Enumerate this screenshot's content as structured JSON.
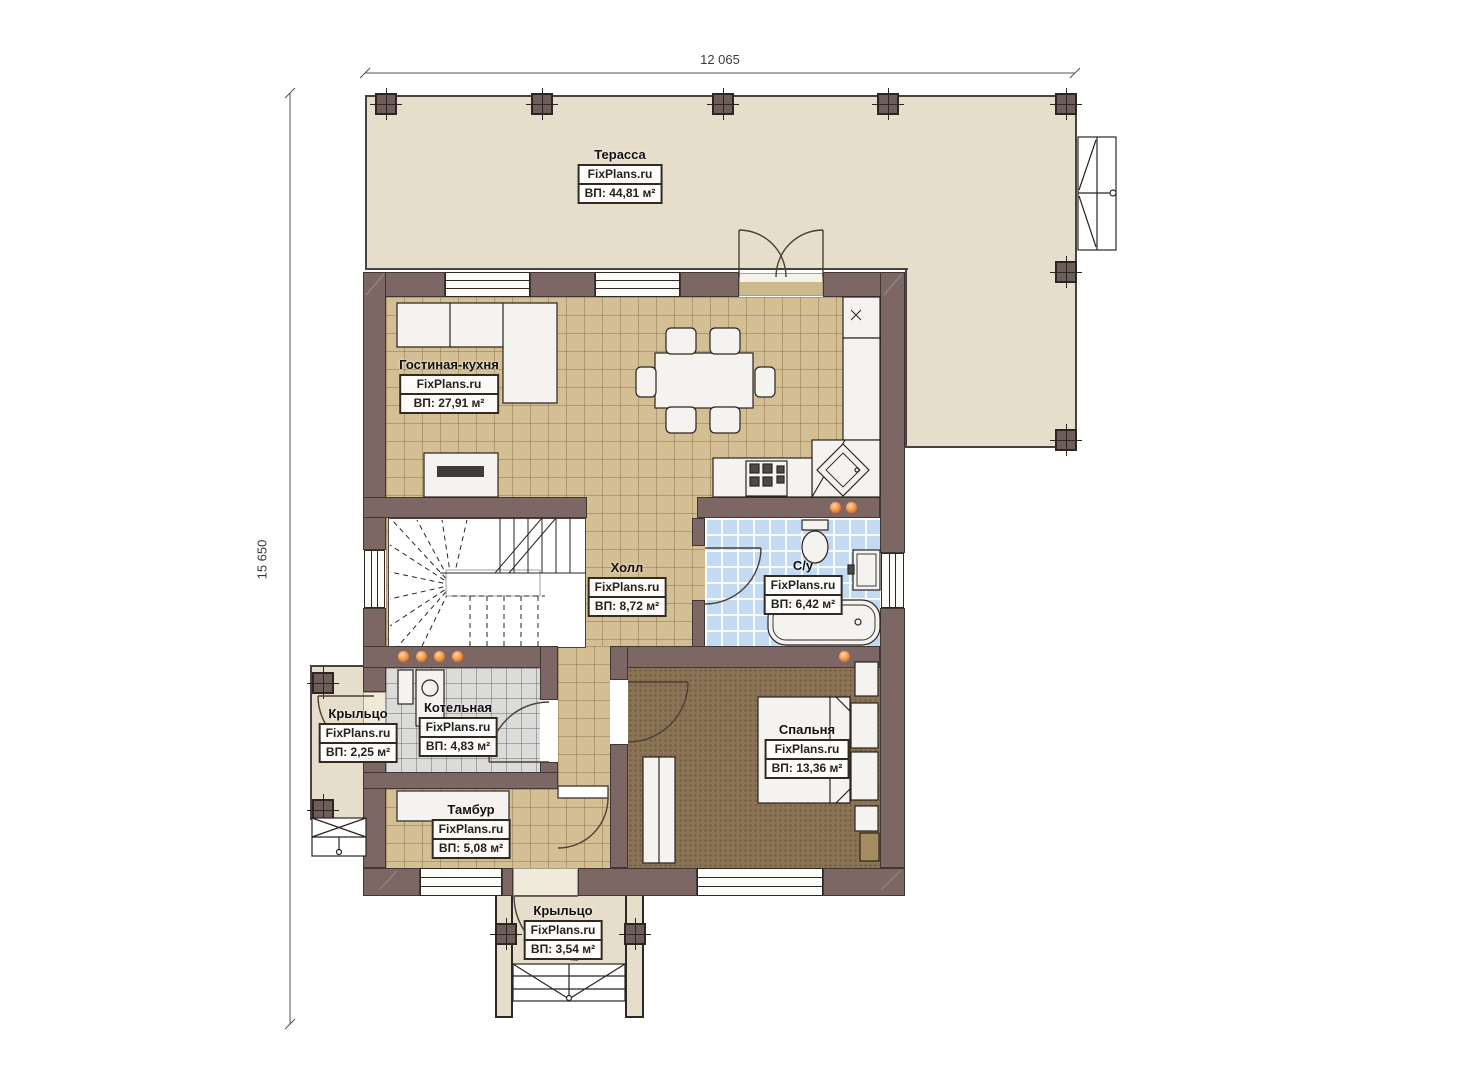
{
  "dimensions": {
    "width_label": "12 065",
    "height_label": "15 650"
  },
  "brand": "FixPlans.ru",
  "rooms": {
    "terrace": {
      "title": "Терасса",
      "area": "ВП: 44,81 м²"
    },
    "living": {
      "title": "Гостиная-кухня",
      "area": "ВП: 27,91 м²"
    },
    "hall": {
      "title": "Холл",
      "area": "ВП: 8,72 м²"
    },
    "bathroom": {
      "title": "С/у",
      "area": "ВП: 6,42 м²"
    },
    "boiler": {
      "title": "Котельная",
      "area": "ВП: 4,83 м²"
    },
    "porch_left": {
      "title": "Крыльцо",
      "area": "ВП: 2,25 м²"
    },
    "bedroom": {
      "title": "Спальня",
      "area": "ВП: 13,36 м²"
    },
    "tambour": {
      "title": "Тамбур",
      "area": "ВП: 5,08 м²"
    },
    "porch_bottom": {
      "title": "Крыльцо",
      "area": "ВП: 3,54 м²"
    }
  },
  "colors": {
    "wall": "#7c6765",
    "terrace_floor": "#e6ddcb",
    "tile_floor": "#d4be94",
    "bath_floor": "#c2daf2",
    "boiler_floor": "#dbdbd9",
    "bedroom_floor": "#8b7355",
    "accent_dot": "#ef8430"
  }
}
